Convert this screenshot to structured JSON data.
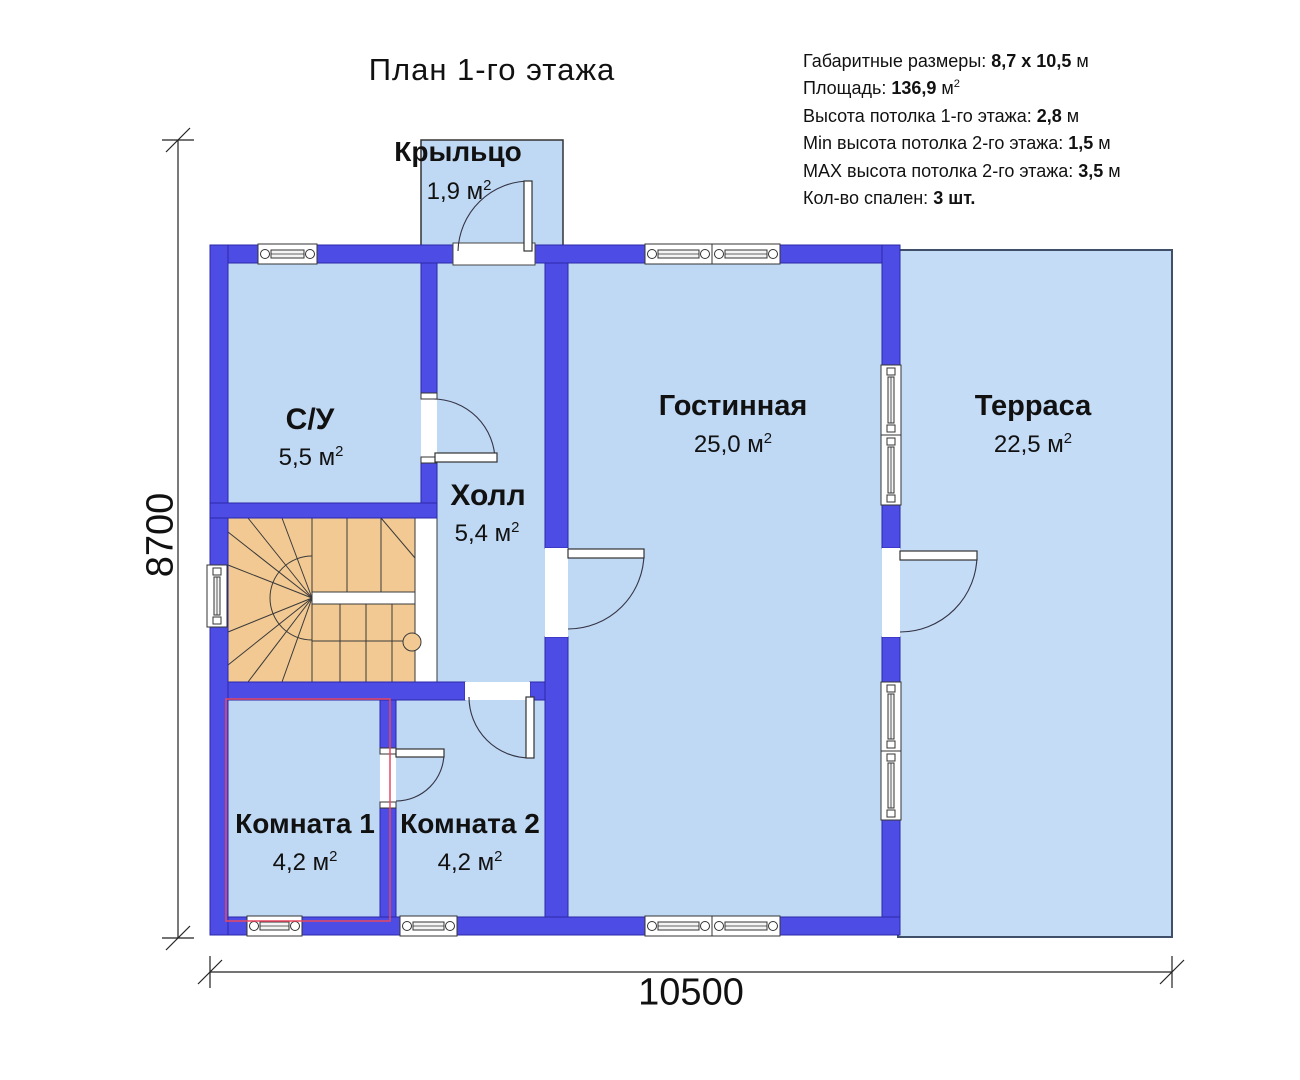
{
  "title": "План 1-го этажа",
  "info": [
    {
      "label": "Габаритные размеры: ",
      "value": "8,7 x 10,5",
      "suffix": " м",
      "sup": ""
    },
    {
      "label": "Площадь: ",
      "value": "136,9",
      "suffix": " м",
      "sup": "2"
    },
    {
      "label": "Высота потолка 1-го этажа: ",
      "value": "2,8",
      "suffix": " м",
      "sup": ""
    },
    {
      "label": "Min высота потолка 2-го этажа: ",
      "value": "1,5",
      "suffix": " м",
      "sup": ""
    },
    {
      "label": "MAX высота потолка 2-го этажа: ",
      "value": "3,5",
      "suffix": " м",
      "sup": ""
    },
    {
      "label": "Кол-во спален: ",
      "value": "3 шт.",
      "suffix": "",
      "sup": ""
    }
  ],
  "rooms": [
    {
      "name": "Крыльцо",
      "area": "1,9 м",
      "sup": "2"
    },
    {
      "name": "С/У",
      "area": "5,5 м",
      "sup": "2"
    },
    {
      "name": "Холл",
      "area": "5,4 м",
      "sup": "2"
    },
    {
      "name": "Гостинная",
      "area": "25,0 м",
      "sup": "2"
    },
    {
      "name": "Терраса",
      "area": "22,5 м",
      "sup": "2"
    },
    {
      "name": "Комната 1",
      "area": "4,2 м",
      "sup": "2"
    },
    {
      "name": "Комната 2",
      "area": "4,2 м",
      "sup": "2"
    }
  ],
  "dimensions": {
    "width": "10500",
    "height": "8700"
  },
  "colors": {
    "wall": "#4d4ce4",
    "wall-edge": "#2a29a8",
    "room-fill": "#bfd8f3",
    "terrace-fill": "#c5dcf6",
    "terrace-edge": "#3f5068",
    "stair-fill": "#f2c993",
    "red-outline": "#e84860",
    "text": "#111111"
  }
}
